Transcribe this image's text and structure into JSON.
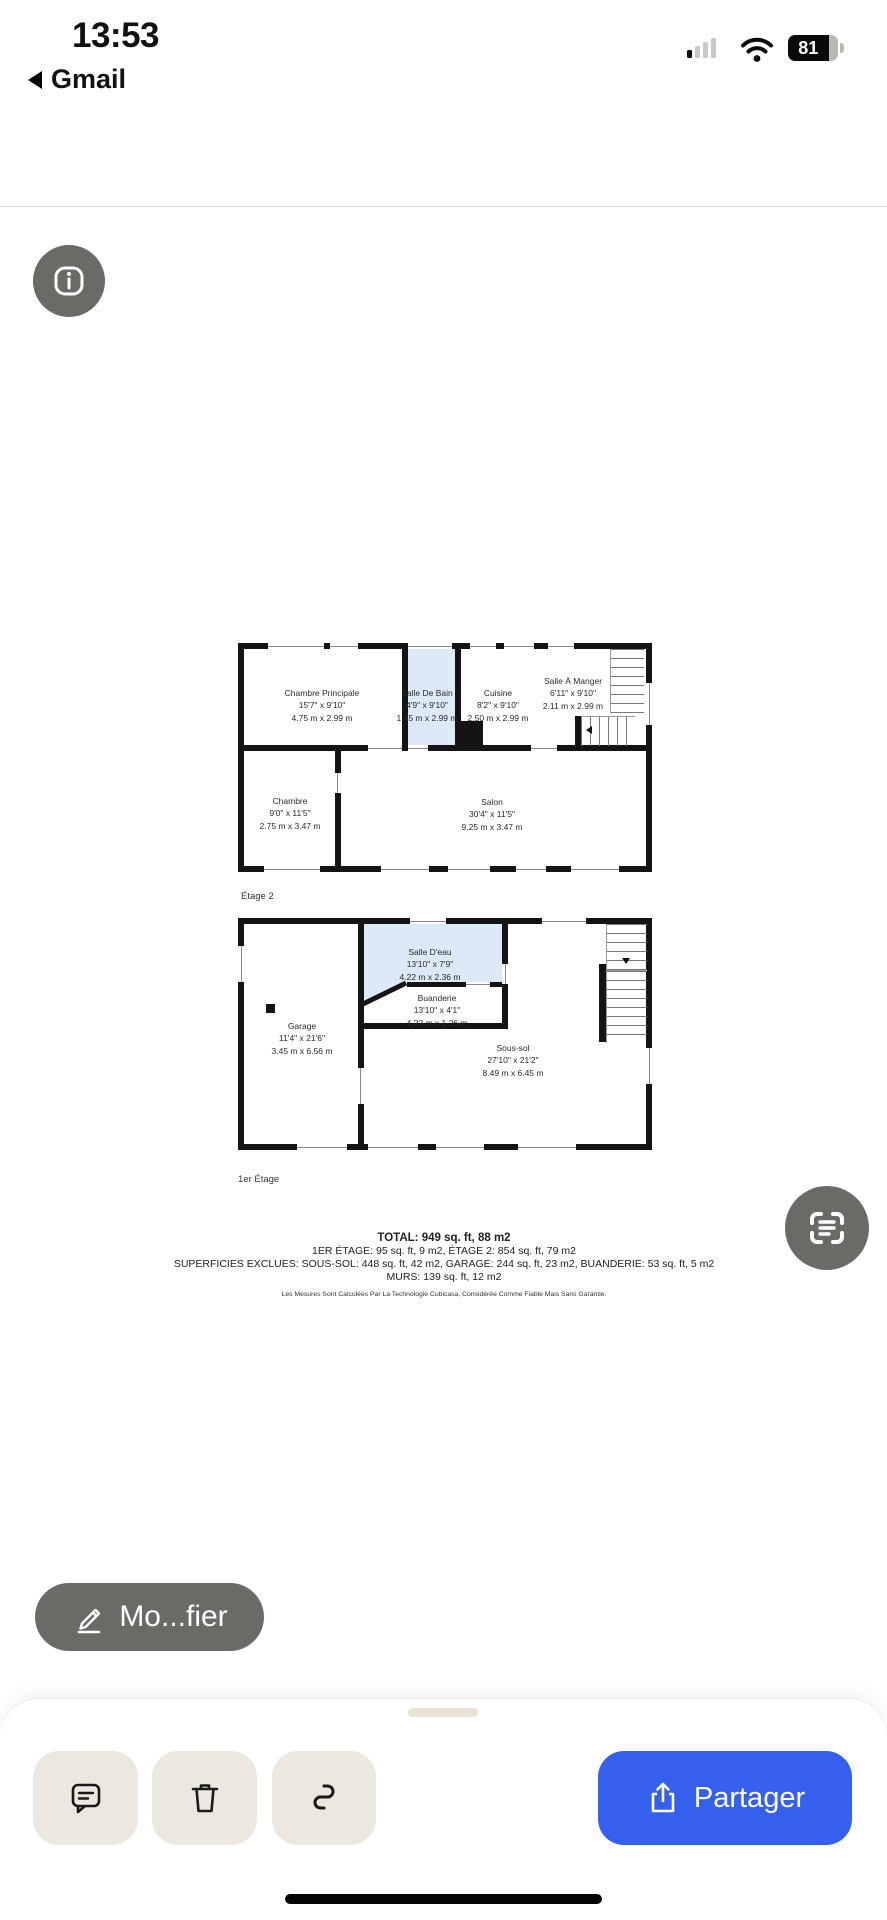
{
  "status_bar": {
    "time": "13:53",
    "back_app": "Gmail",
    "battery_percent": "81"
  },
  "header": {
    "title": "all_floors_9...with_dim.jpg"
  },
  "viewer": {
    "floor2": {
      "label": "Étage 2",
      "rooms": [
        {
          "name": "Chambre Principale",
          "imperial": "15'7\" x 9'10\"",
          "metric": "4.75 m x 2.99 m"
        },
        {
          "name": "Salle De Bain",
          "imperial": "4'9\" x 9'10\"",
          "metric": "1.45 m x 2.99 m"
        },
        {
          "name": "Cuisine",
          "imperial": "8'2\" x 9'10\"",
          "metric": "2.50 m x 2.99 m"
        },
        {
          "name": "Salle À Manger",
          "imperial": "6'11\" x 9'10\"",
          "metric": "2.11 m x 2.99 m"
        },
        {
          "name": "Chambre",
          "imperial": "9'0\" x 11'5\"",
          "metric": "2.75 m x 3.47 m"
        },
        {
          "name": "Salon",
          "imperial": "30'4\" x 11'5\"",
          "metric": "9.25 m x 3.47 m"
        }
      ]
    },
    "floor1": {
      "label": "1er Étage",
      "rooms": [
        {
          "name": "Salle D'eau",
          "imperial": "13'10\" x 7'9\"",
          "metric": "4.22 m x 2.36 m"
        },
        {
          "name": "Buanderie",
          "imperial": "13'10\" x 4'1\"",
          "metric": "4.22 m x 1.26 m"
        },
        {
          "name": "Garage",
          "imperial": "11'4\" x 21'6\"",
          "metric": "3.45 m x 6.56 m"
        },
        {
          "name": "Sous-sol",
          "imperial": "27'10\" x 21'2\"",
          "metric": "8.49 m x 6.45 m"
        }
      ]
    },
    "summary": {
      "total": "TOTAL: 949 sq. ft, 88 m2",
      "line2": "1ER ÉTAGE: 95 sq. ft, 9 m2, ÉTAGE 2: 854 sq. ft, 79 m2",
      "line3": "SUPERFICIES EXCLUES: SOUS-SOL: 448 sq. ft, 42 m2, GARAGE: 244 sq. ft, 23 m2, BUANDERIE: 53 sq. ft, 5 m2",
      "line4": "MURS: 139 sq. ft, 12 m2",
      "disclaimer": "Les Mesures Sont Calculées Par La Technologie Cubicasa, Considérée Comme Fiable Mais Sans Garantie."
    }
  },
  "actions": {
    "modify_label": "Mo...fier",
    "share_label": "Partager"
  },
  "colors": {
    "accent_blue": "#3560ed",
    "button_beige": "#ece8df",
    "overlay_gray": "#6b6a66",
    "room_highlight": "#dce9f6"
  }
}
